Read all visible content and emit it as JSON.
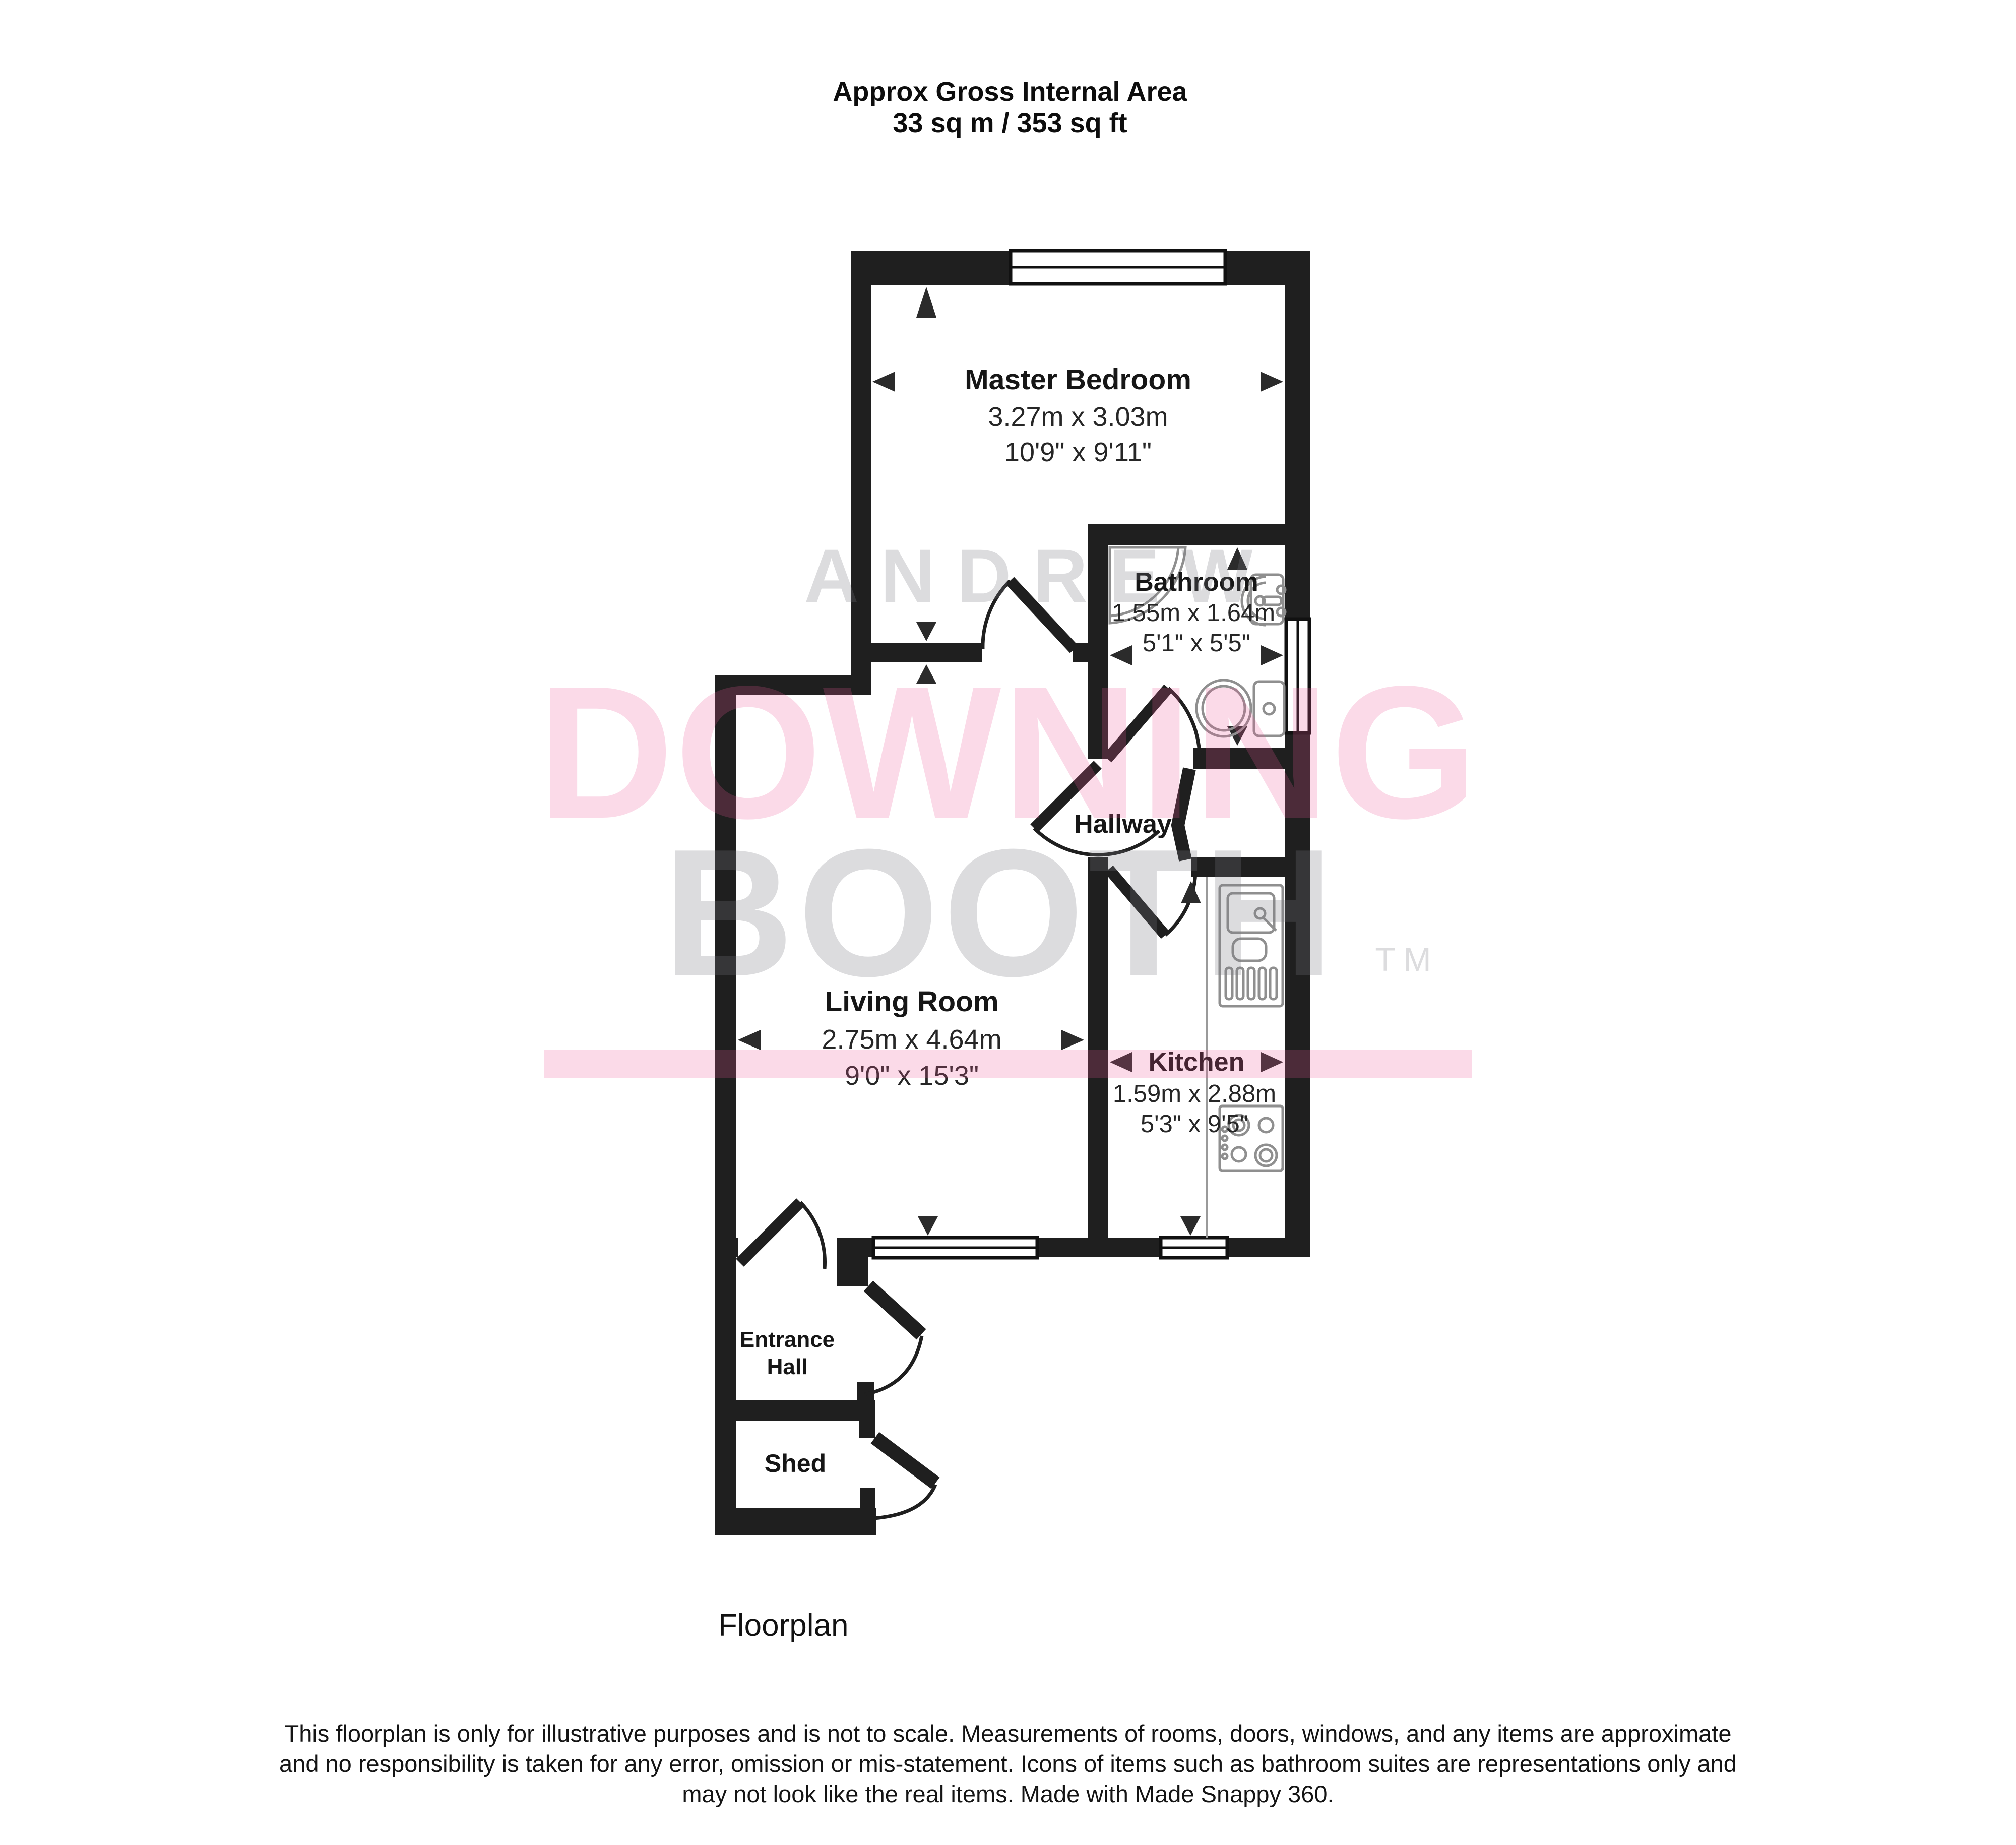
{
  "title": {
    "line1": "Approx Gross Internal Area",
    "line2": "33 sq m / 353 sq ft"
  },
  "rooms": {
    "master_bedroom": {
      "name": "Master Bedroom",
      "metric": "3.27m x 3.03m",
      "imperial": "10'9\" x 9'11\""
    },
    "bathroom": {
      "name": "Bathroom",
      "metric": "1.55m x 1.64m",
      "imperial": "5'1\" x 5'5\""
    },
    "hallway": {
      "name": "Hallway"
    },
    "living_room": {
      "name": "Living Room",
      "metric": "2.75m x 4.64m",
      "imperial": "9'0\" x 15'3\""
    },
    "kitchen": {
      "name": "Kitchen",
      "metric": "1.59m x 2.88m",
      "imperial": "5'3\" x 9'5\""
    },
    "entrance_hall": {
      "name_line1": "Entrance",
      "name_line2": "Hall"
    },
    "shed": {
      "name": "Shed"
    }
  },
  "watermark": {
    "word1": "ANDREW",
    "word2": "DOWNING",
    "word3": "BOOTH",
    "tm": "TM",
    "pink": "rgba(236,88,152,0.22)",
    "gray": "rgba(118,120,126,0.26)"
  },
  "caption": "Floorplan",
  "disclaimer": {
    "line1": "This floorplan is only for illustrative purposes and is not to scale. Measurements of rooms, doors, windows, and any items are approximate",
    "line2": "and no responsibility is taken for any error, omission or mis-statement. Icons of items such as bathroom suites are representations only and",
    "line3": "may not look like the real items. Made with Made Snappy 360."
  }
}
